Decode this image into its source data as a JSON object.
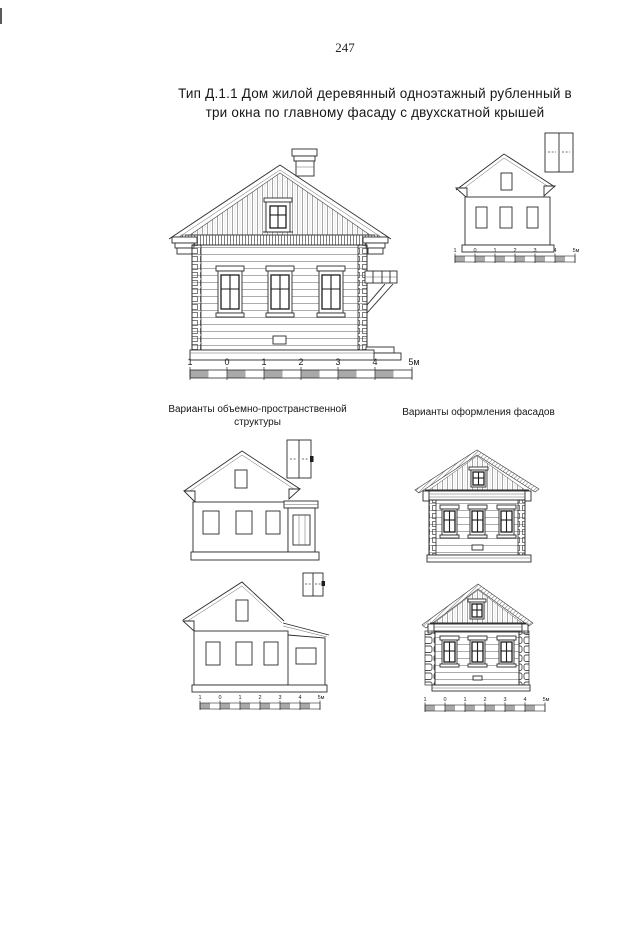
{
  "page": {
    "number": "247",
    "title_line1": "Тип Д.1.1 Дом жилой деревянный одноэтажный рубленный в",
    "title_line2": "три окна по главному фасаду с двухскатной крышей"
  },
  "sections": {
    "left_header_line1": "Варианты объемно-пространственной",
    "left_header_line2": "структуры",
    "right_header": "Варианты оформления фасадов"
  },
  "scale_bar": {
    "labels": [
      "1",
      "0",
      "1",
      "2",
      "3",
      "4",
      "5м"
    ]
  }
}
